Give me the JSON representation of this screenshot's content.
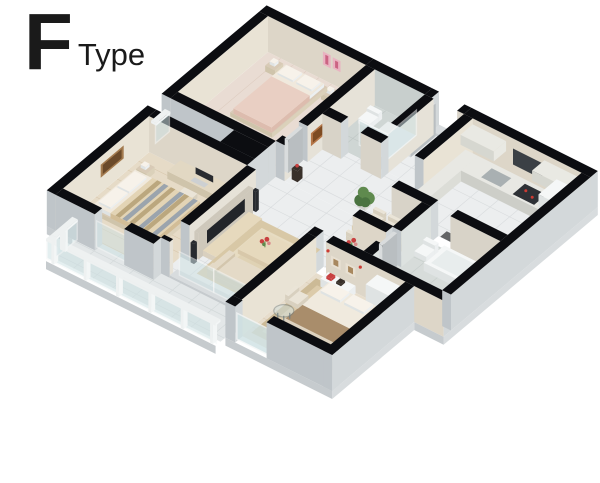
{
  "title": {
    "letter": "F",
    "word": "Type"
  },
  "scene": {
    "type": "isometric-3d-floor-plan",
    "rooms": [
      "bedroom-top",
      "shower-bathroom",
      "entry-hall",
      "kitchen",
      "dining-area",
      "vanity-nook",
      "bathroom-tub",
      "living-room",
      "bedroom-left",
      "master-bedroom",
      "balcony-small",
      "balcony-living"
    ]
  },
  "palette": {
    "bg": "#ffffff",
    "titleInk": "#1a1a1a",
    "wallTop": "#0c0d11",
    "extL": "#bfc5c9",
    "extR": "#d3d8da",
    "intBeigeL": "#ddd6c8",
    "intBeigeR": "#e9e3d5",
    "intLightL": "#d8d3c8",
    "intLightR": "#e6e2d8",
    "showerIntL": "#c8cfcd",
    "bathIntR": "#dde2e0",
    "tile": "#eceeef",
    "tileLn": "#d9dcde",
    "showerFloor": "#cfd6d4",
    "showerLn": "#bfc7c5",
    "bathFloor": "#d7dcda",
    "bathLn": "#c7cecb",
    "woodA": "#e9dcd3",
    "woodALn": "#dccabe",
    "woodB": "#e6dbc7",
    "woodBLn": "#d6c5a9",
    "woodM": "#e7ddcc",
    "woodMLn": "#d8c9b2",
    "balc": "#e3e7e8",
    "balcLn": "#d2d8d9",
    "slabL": "#c6cbce",
    "slabR": "#d8dcde",
    "glass": "#cfe2e4",
    "glassFrame": "#f3f6f6",
    "post": "#eef1f1",
    "bedFrame": "#d8cab6",
    "mattress": "#f0e9dd",
    "pillow": "#f7f2ea",
    "quiltA": "#e9cfc3",
    "quiltASh": "#ddbcae",
    "quiltB": "#e3d4b5",
    "quiltBSh": "#d2bd97",
    "stripeTan": "#b49f74",
    "stripeBlue": "#8e9bab",
    "duvet": "#f0eade",
    "duvetSh": "#ddd2bf",
    "throw": "#a98d6b",
    "rug1": "#d8c8a6",
    "rug1In": "#e7dcc2",
    "rug2": "#ccba96",
    "rug2In": "#dccbaa",
    "sofa": "#e4dac7",
    "sofaSh": "#d3c6ad",
    "tbl": "#d8c8aa",
    "tblTop": "#e6d9bd",
    "tvPanel": "#cec8bb",
    "tvScreen": "#22252a",
    "tvCab": "#d9d0bf",
    "counterTop": "#e8e8e3",
    "counterL": "#cdcec8",
    "counterR": "#dcddd7",
    "sink": "#a9b0b2",
    "stove": "#2e3136",
    "stoveDot": "#cc3b33",
    "cabinet": "#e9e9e3",
    "cabinetSh": "#d6d7d0",
    "white": "#f5f7f7",
    "whiteL": "#dfe3e3",
    "whiteR": "#eceff0",
    "tubIn": "#e8eded",
    "deskTop": "#e2d8c3",
    "deskL": "#cfc4ab",
    "deskR": "#dbd1ba",
    "monitor": "#282b30",
    "keyb": "#cdd0d2",
    "chair": "#eae4d7",
    "chairSh": "#d8d0bf",
    "doorLeaf": "#d9dcdd",
    "doorLeafSh": "#b9bec1",
    "matDark": "#4b4b4e",
    "vase": "#38302a",
    "pot": "#979d97",
    "plant1": "#5f8a4e",
    "plant2": "#4a7340",
    "flowerR": "#c84040",
    "flowerP": "#d98a8a",
    "stemG": "#6e9a5e",
    "artP1": "#e9b3c1",
    "artP2": "#cb6483",
    "artB1": "#a37a4e",
    "artB2": "#6b4a2a",
    "artO1": "#b57648",
    "artO2": "#7e4b22",
    "artM1": "#e8e0d2",
    "artM2": "#a8885f",
    "sconce": "#cc3b33",
    "windowDark": "#3b4045"
  }
}
